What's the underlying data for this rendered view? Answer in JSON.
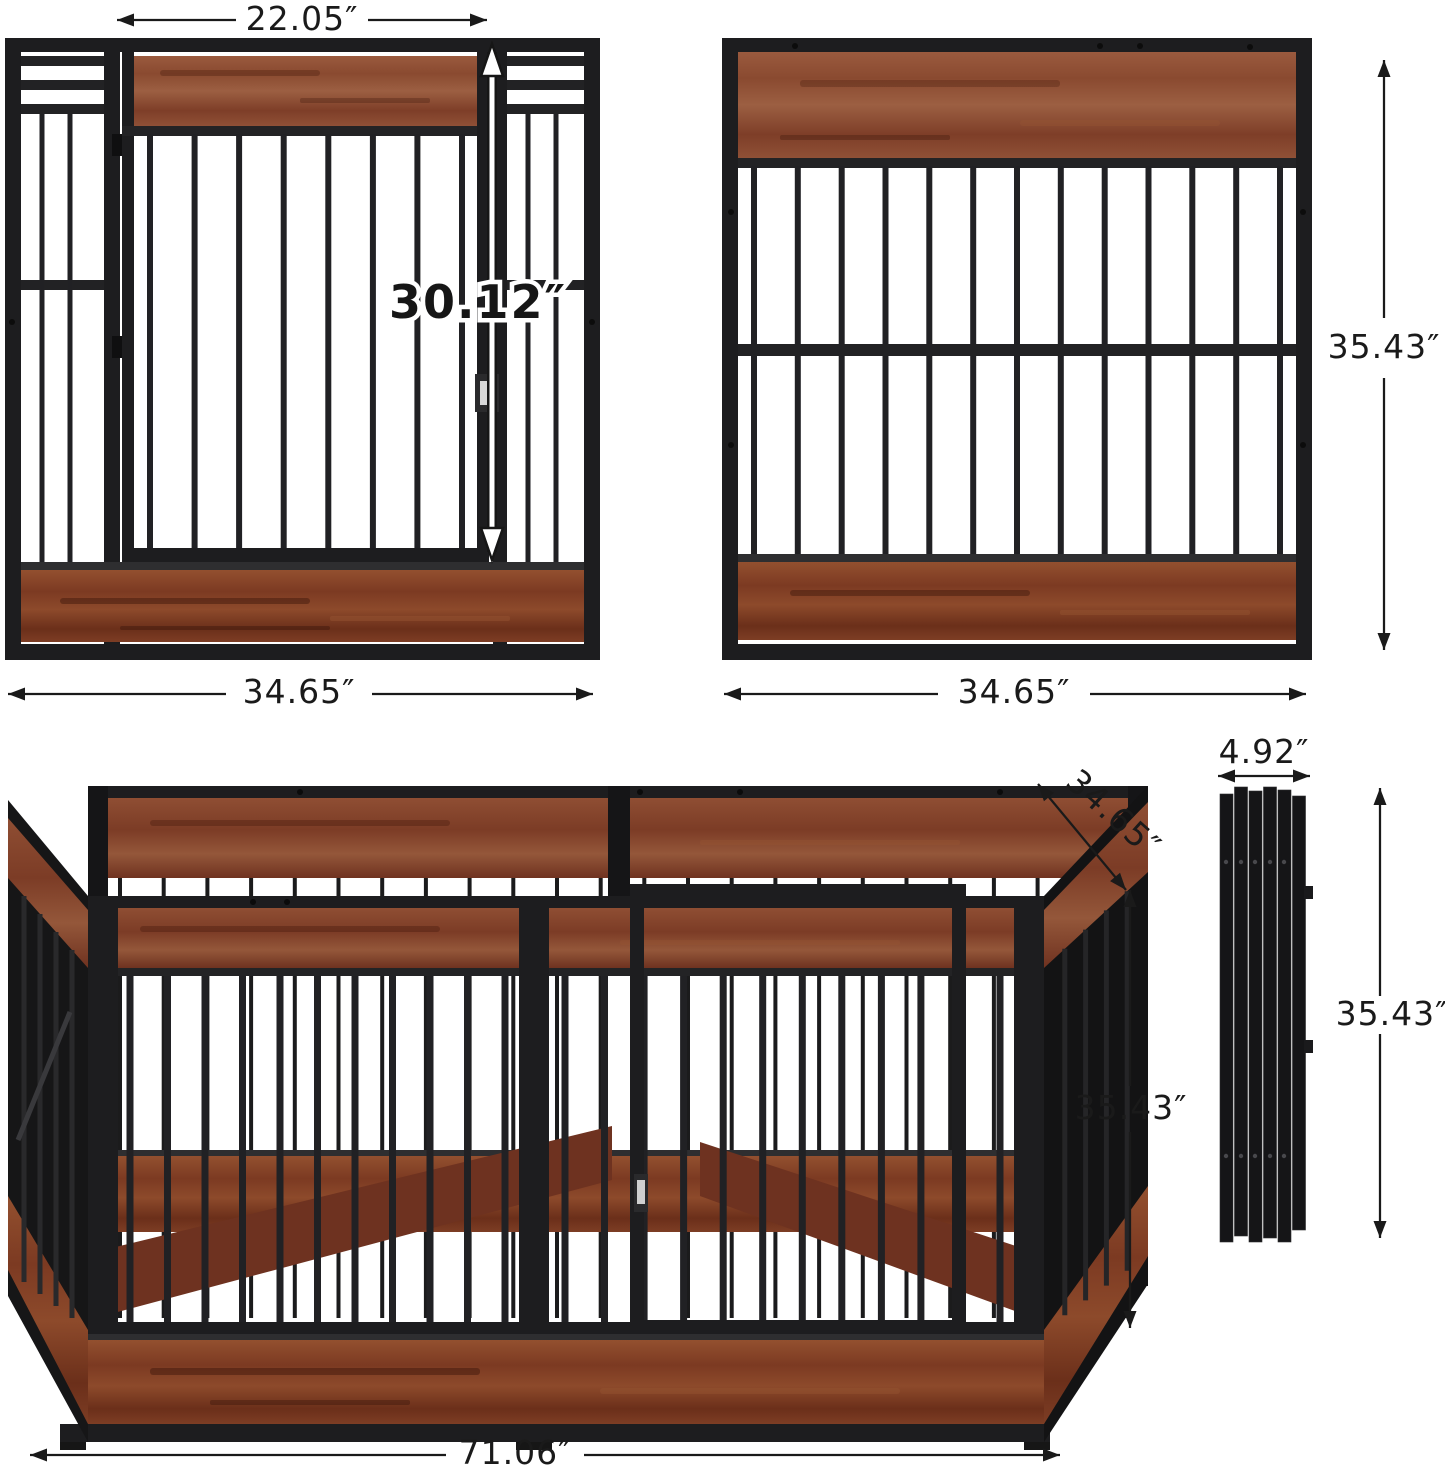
{
  "image_type": "product dimension diagram",
  "product": "heavy-duty wood and metal dog crate playpen panels",
  "views": {
    "door_panel": {
      "name": "front panel with door",
      "door_width": "22.05″",
      "door_height": "30.12″",
      "panel_width": "34.65″"
    },
    "plain_panel": {
      "name": "side panel without door",
      "panel_width": "34.65″",
      "panel_height": "35.43″"
    },
    "assembled_pen": {
      "name": "assembled playpen",
      "depth": "34.65″",
      "height": "35.43″",
      "width": "71.06″"
    },
    "folded_stack": {
      "name": "folded flat panels",
      "width": "4.92″",
      "height": "35.43″"
    }
  },
  "colors": {
    "background": "#ffffff",
    "metal": "#1d1d1f",
    "metal_mid": "#2e2e30",
    "wood": "#8a4a30",
    "wood_plank": "#7c3a22",
    "dimension_line": "#1a1a1a",
    "door_arrow": "#ffffff"
  }
}
